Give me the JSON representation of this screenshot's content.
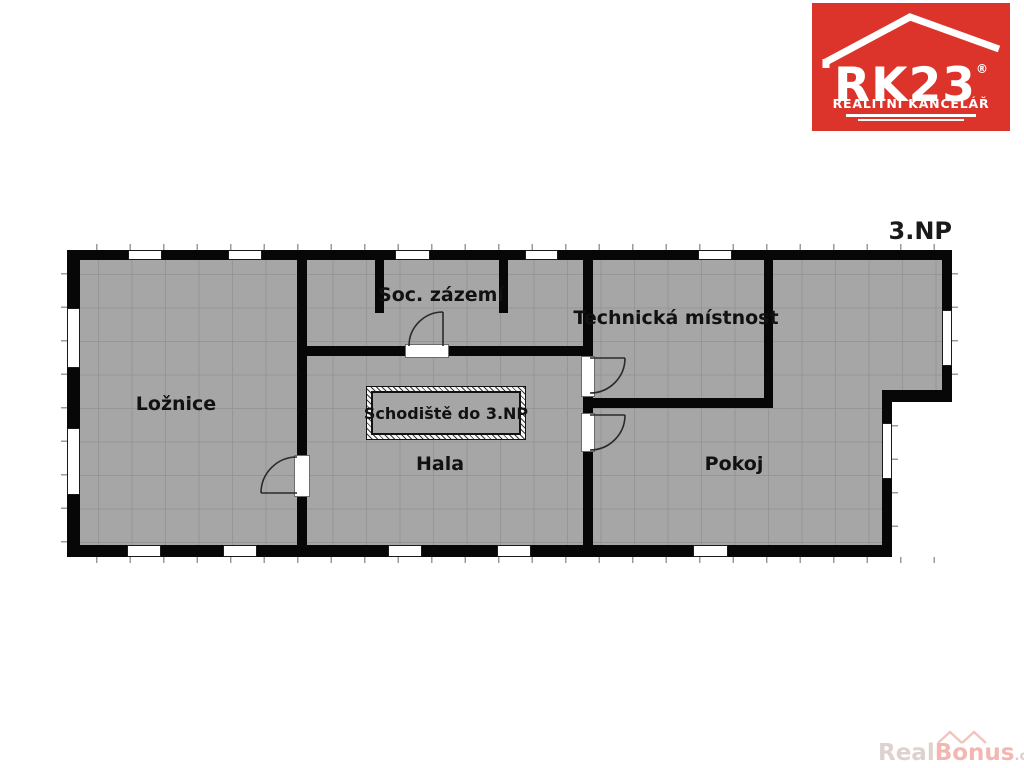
{
  "plan": {
    "level": "3.NP"
  },
  "rooms": {
    "loznice": "Ložnice",
    "soc_zazemi": "Soc. zázemí",
    "technicka_mistnost": "Technická místnost",
    "hala": "Hala",
    "pokoj": "Pokoj",
    "schodiste": "Schodiště do 3.NP"
  },
  "logo": {
    "brand": "RK23",
    "registered": "®",
    "tagline": "REALITNÍ KANCELÁŘ",
    "bg_color": "#dc342b"
  },
  "watermark": {
    "real": "Real",
    "bonus": "Bonus",
    "cz": ".cz"
  },
  "colors": {
    "wall": "#070707",
    "floor": "#a6a6a6",
    "grid": "#969696",
    "logo_red": "#dc342b"
  }
}
